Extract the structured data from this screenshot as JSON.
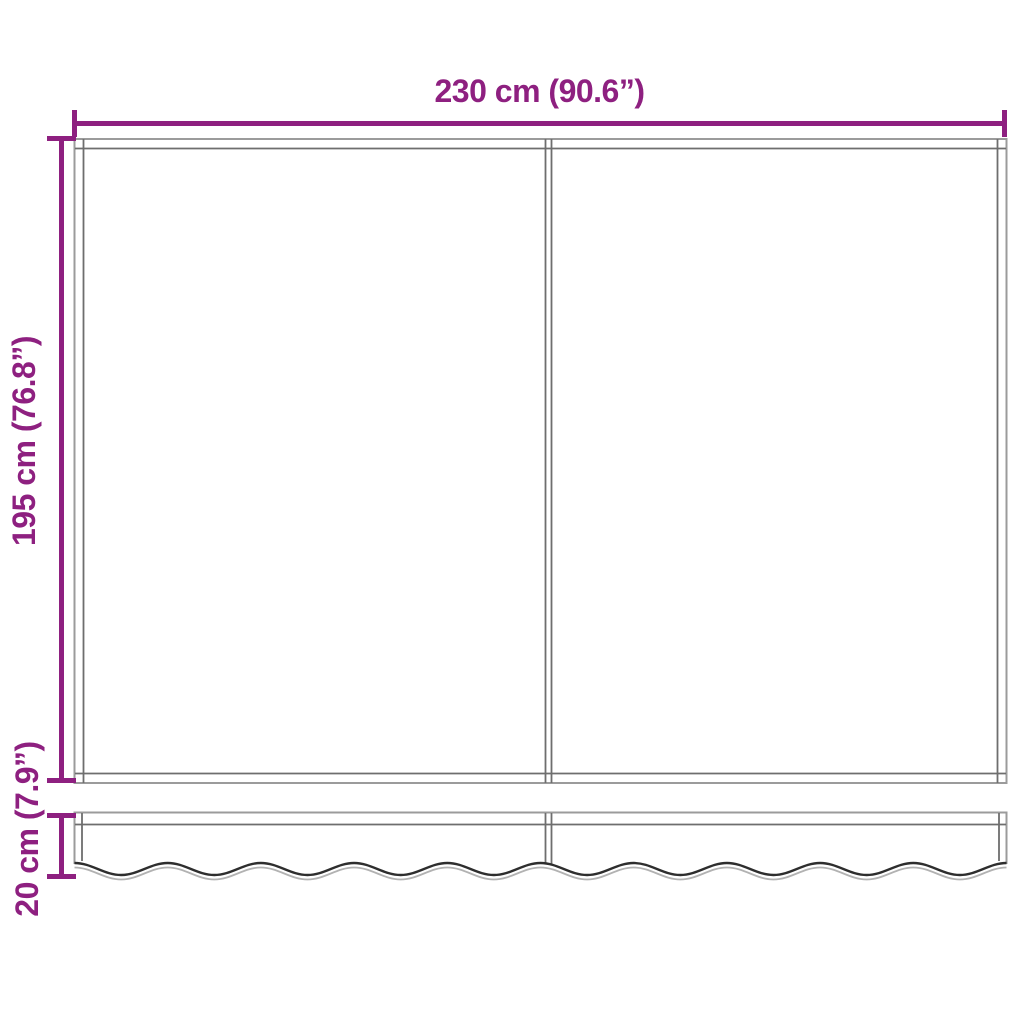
{
  "diagram": {
    "dimensions": {
      "width": {
        "label": "230 cm (90.6”)",
        "value_cm": 230,
        "value_inch": 90.6
      },
      "height": {
        "label": "195 cm (76.8”)",
        "value_cm": 195,
        "value_inch": 76.8
      },
      "valance_height": {
        "label": "20 cm (7.9”)",
        "value_cm": 20,
        "value_inch": 7.9
      }
    }
  },
  "colors": {
    "accent": "#8e2080",
    "outline": "#9b9b9b",
    "hem": "#6e6e6e",
    "wave_dark": "#2e2e2e",
    "wave_light": "#b2b2b2",
    "background": "#ffffff"
  }
}
